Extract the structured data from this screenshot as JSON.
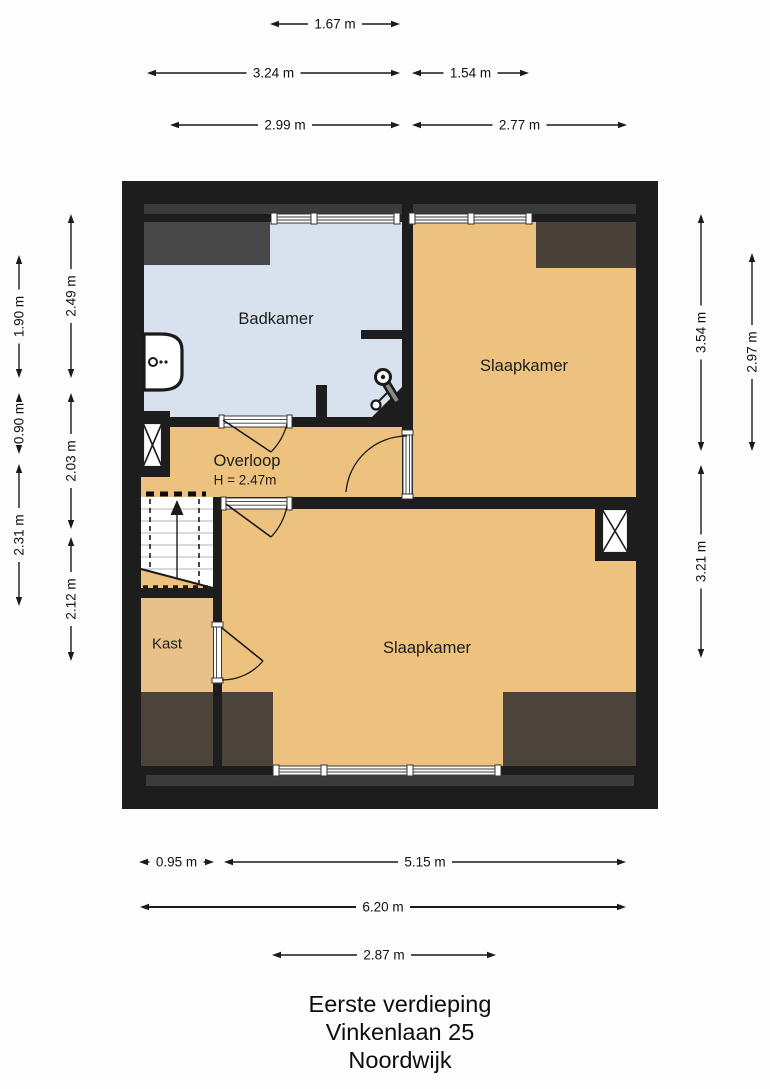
{
  "title": {
    "line1": "Eerste verdieping",
    "line2": "Vinkenlaan 25",
    "line3": "Noordwijk"
  },
  "rooms": {
    "badkamer": {
      "label": "Badkamer"
    },
    "slaapkamer_boven": {
      "label": "Slaapkamer"
    },
    "overloop": {
      "label": "Overloop",
      "height_note": "H = 2.47m"
    },
    "kast": {
      "label": "Kast"
    },
    "slaapkamer_onder": {
      "label": "Slaapkamer"
    }
  },
  "dimensions": {
    "top": [
      "1.67 m",
      "3.24 m",
      "1.54 m",
      "2.99 m",
      "2.77 m"
    ],
    "left_outer": [
      "1.90 m",
      "0.90 m",
      "2.31 m"
    ],
    "left_inner": [
      "2.49 m",
      "2.03 m",
      "2.12 m"
    ],
    "right_inner": [
      "3.54 m",
      "3.21 m"
    ],
    "right_outer": [
      "2.97 m"
    ],
    "bottom": [
      "0.95 m",
      "5.15 m",
      "6.20 m",
      "2.87 m"
    ]
  },
  "fixtures": {
    "sink": "wastafel",
    "toilet": "toilet",
    "stairs": "trap",
    "shaft_left": "schacht",
    "shaft_right": "schacht"
  },
  "colors": {
    "wall": "#1d1d1d",
    "floor_orange": "#ecc27e",
    "floor_bathroom_blue": "#d7e2ee",
    "floor_kast": "#e7c08a",
    "slope_gray": "#474747",
    "eaves_band_gray": "#3b3b3b",
    "attic_brown_top": "#4a4138",
    "attic_brown_bottom": "#4c433a",
    "dim_text": "#111111"
  }
}
